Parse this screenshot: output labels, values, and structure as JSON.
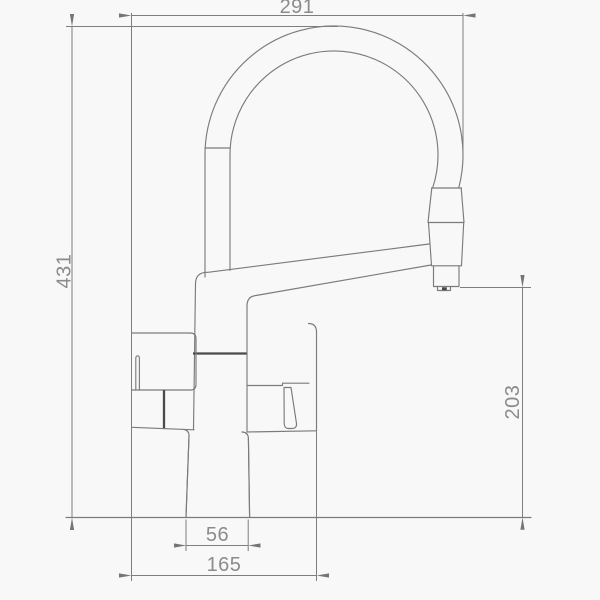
{
  "drawing": {
    "type": "technical-dimension-drawing",
    "subject": "kitchen faucet with spring spout, side elevation",
    "dimensions": {
      "overall_width": "291",
      "overall_height": "431",
      "outlet_height": "203",
      "base_width": "56",
      "body_span": "165"
    },
    "colors": {
      "background": "#f8f8f8",
      "line": "#7b7b7b",
      "dark_line": "#4a4a4a",
      "text": "#8b8b8b"
    }
  }
}
